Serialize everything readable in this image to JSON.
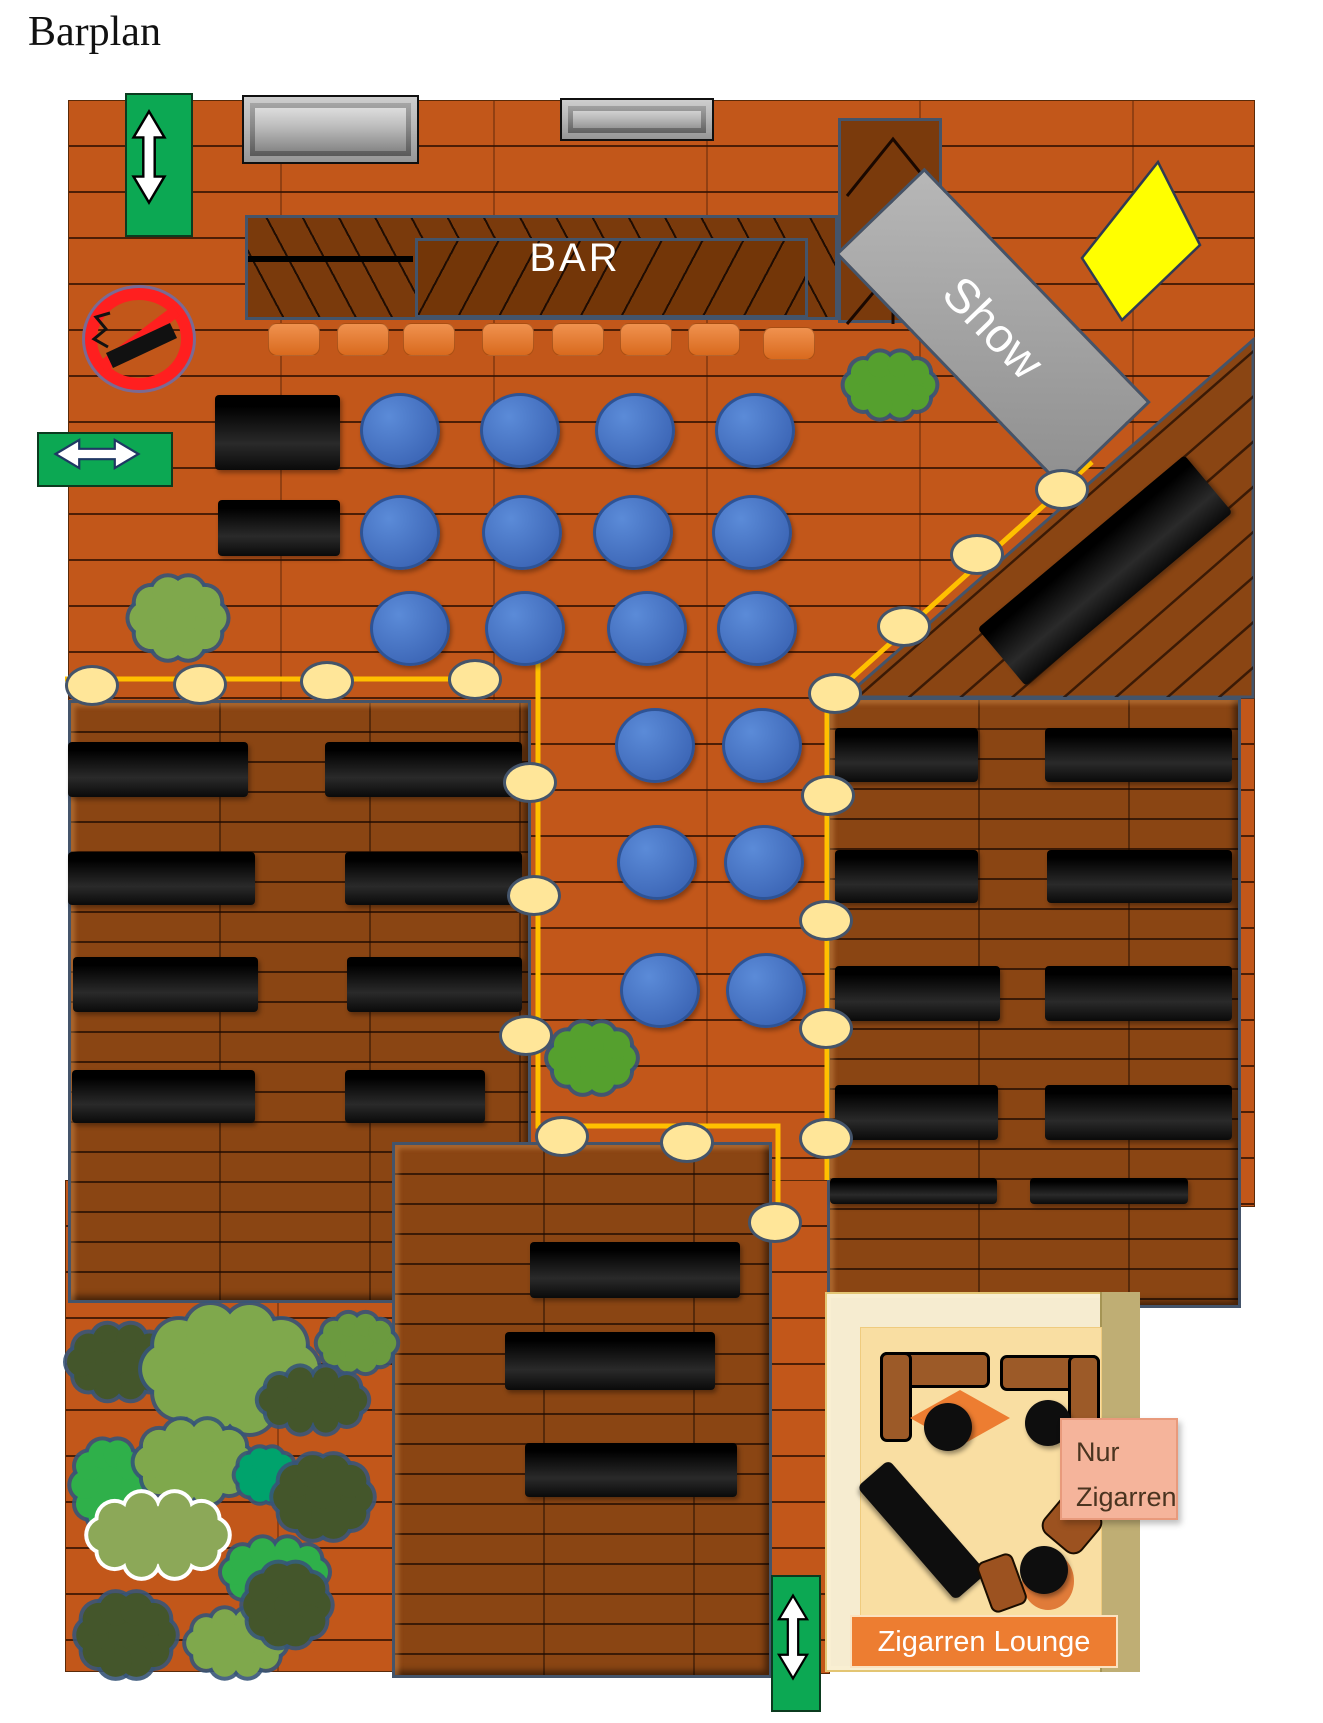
{
  "labels": {
    "title": "Barplan",
    "bar": "BAR",
    "stage": "Show",
    "lounge_sign_line1": "Nur",
    "lounge_sign_line2": "Zigarren",
    "lounge_banner": "Zigarren Lounge"
  },
  "colors": {
    "floor_orange": "#C2571A",
    "deck_brown": "#8A4513",
    "bar_wood": "#7A3A0C",
    "table_black": "#0d0d0d",
    "seat_blue": "#4472C4",
    "seat_border": "#2E5395",
    "stool_orange": "#ED7D31",
    "light_line": "#FFC000",
    "light_bulb": "#FFE699",
    "bulb_border": "#44546A",
    "exit_green": "#0CA853",
    "stage_gray": "#A6A6A6",
    "spotlight_yellow": "#FFFF00",
    "no_smoking_red": "#FF1F1F",
    "lounge_cream": "#F9DEA2",
    "sign_salmon": "#F5B49B",
    "banner_orange": "#ED7D31"
  },
  "inventory": {
    "blue_seats": 18,
    "bar_stools": 8,
    "black_tables": 25,
    "string_light_bulbs": 18,
    "bushes": 16,
    "exit_arrows": 3,
    "windows": 2
  }
}
